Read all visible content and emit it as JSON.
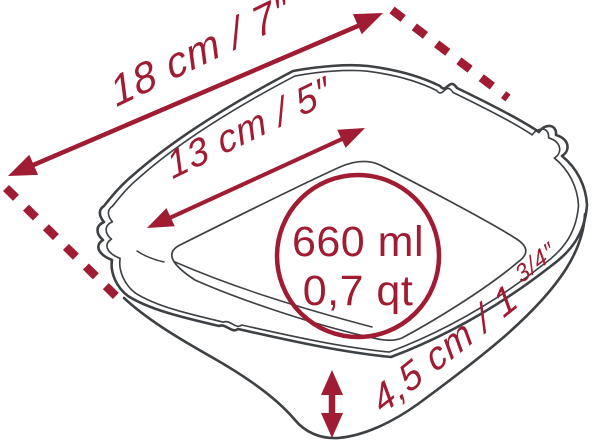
{
  "illustration": "square-baking-dish-line-art",
  "colors": {
    "accent_red": "#a01c32",
    "line_gray": "#3e4144",
    "background": "#ffffff"
  },
  "dimensions": {
    "outer_width": {
      "label": "18 cm / 7″"
    },
    "inner_width": {
      "label": "13 cm / 5″"
    },
    "height": {
      "label_main": "4,5 cm / 1 ",
      "label_sup": "3/4″"
    }
  },
  "capacity": {
    "volume_metric": "660 ml",
    "volume_us": "0,7 qt"
  }
}
